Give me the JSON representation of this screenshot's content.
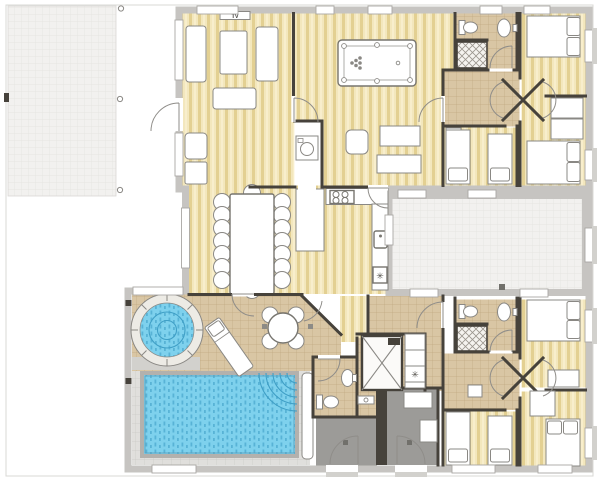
{
  "title": "house-floor-plan",
  "labels": {
    "tv": "TV",
    "snowflake": "✳"
  },
  "colors": {
    "bg": "#ffffff",
    "boundary": "#d9d8d5",
    "wallOuter": "#c6c4c1",
    "wallDark": "#46423b",
    "fixtureFill": "#ffffff",
    "fixtureStroke": "#8a8884",
    "doorStroke": "#8f8d89",
    "wood": "#f3e7bd",
    "woodStripe": "#e3d092",
    "woodLight": "#fdf6da",
    "tile": "#d9c6a4",
    "tileLine": "#c0a981",
    "paving": "#f2f1ef",
    "pavingLine": "#e3e2de",
    "tileGray": "#e0dfdc",
    "tileGrayLine": "#cbcac6",
    "poolWater": "#7ed1ed",
    "poolMark": "#3f9fc6",
    "poolCoping": "#b3b1ad",
    "grayRoom": "#9c9b98",
    "grayLight": "#d2d1cd",
    "drain": "#71706b",
    "hatch": "#9b968e",
    "hatchBg": "#f5f3ef"
  },
  "rooms": [
    "patio",
    "living-room",
    "game-room",
    "utility-closet",
    "dining-room",
    "kitchen",
    "courtyard",
    "bathroom-north",
    "bedroom-1",
    "bedroom-2",
    "bedroom-3",
    "terrace",
    "jacuzzi",
    "pool",
    "pool-bathroom",
    "sauna",
    "utility-column",
    "storage-1",
    "storage-2",
    "bathroom-south",
    "bedroom-4",
    "bedroom-5",
    "bedroom-6"
  ]
}
